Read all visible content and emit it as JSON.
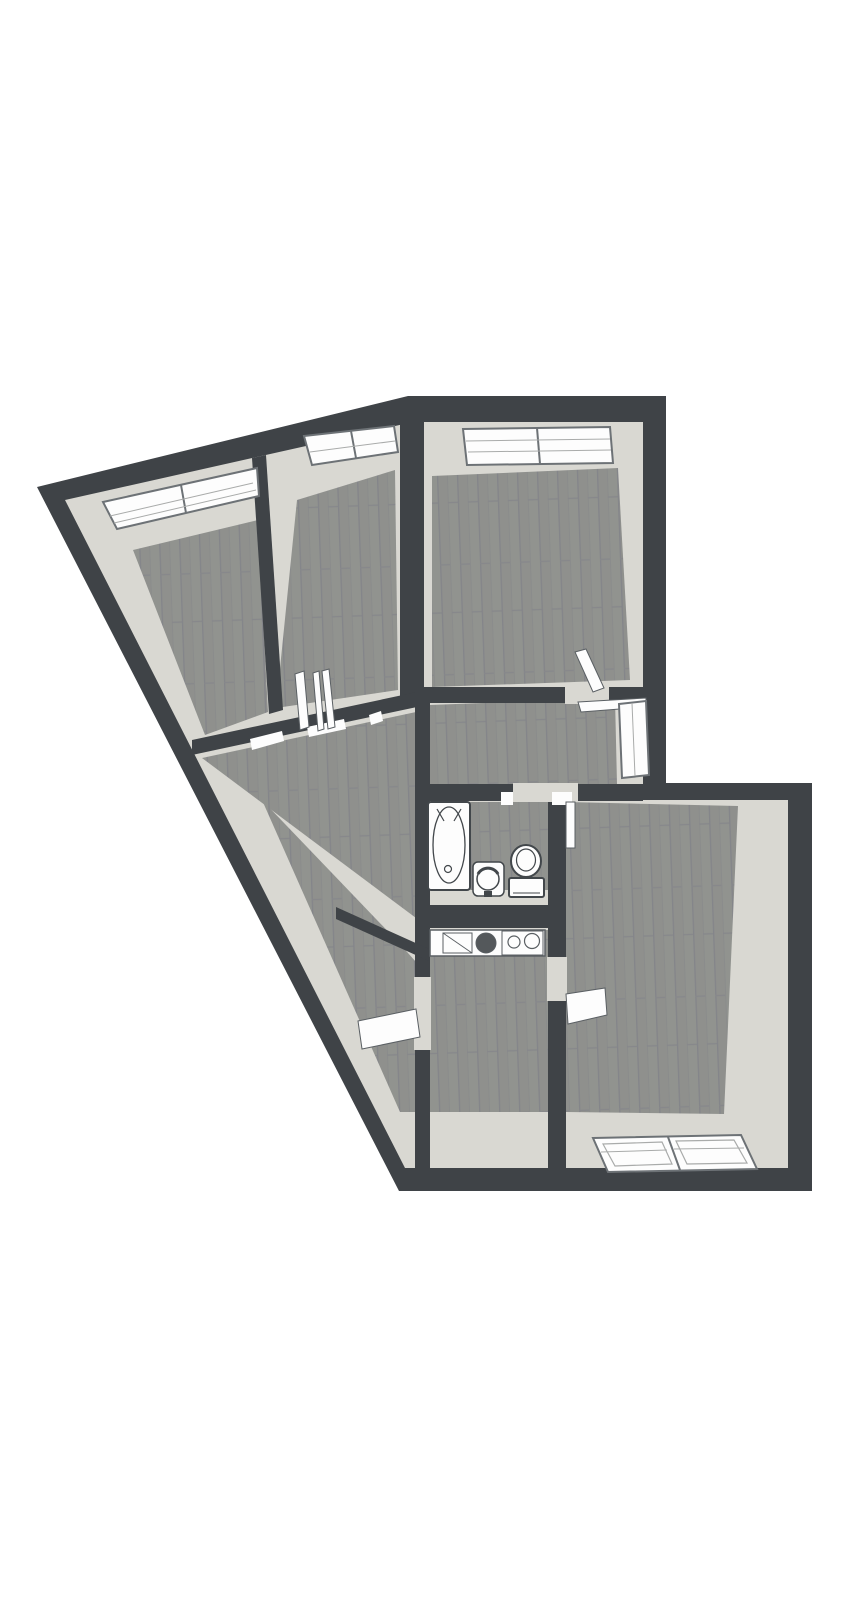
{
  "document": {
    "kind": "3d-floorplan-render",
    "description": "Top-down 3D render of an apartment floor plan, no text labels",
    "canvas": {
      "width": 867,
      "height": 1600
    }
  },
  "colors": {
    "bg": "#ffffff",
    "wall": "#3f4347",
    "face": "#d9d8d2",
    "white": "#fdfdfd",
    "outline": "#5a5f63",
    "frame": "#6d7276",
    "pane": "#a9abaa",
    "fixture": "#42474b",
    "basin": "#54585b",
    "wood_base": "#8f908d",
    "wood_half": "#94958f",
    "wood_stripe": "#84858a",
    "wood_joint": "#87888b"
  },
  "shapes": [
    {
      "name": "background",
      "type": "rect",
      "x": 0,
      "y": 0,
      "w": 867,
      "h": 1600,
      "fill": "bg"
    },
    {
      "name": "outer-wall",
      "type": "polygon",
      "points": "37,487 408,396 666,396 666,783 812,783 812,1191 399,1191",
      "fill": "wall"
    },
    {
      "name": "interior-wall-faces",
      "type": "polygon",
      "points": "65,500 413,422 643,422 643,800 788,800 788,1168 405,1168",
      "fill": "face"
    },
    {
      "name": "room1-floor",
      "type": "polygon",
      "points": "133,550 258,520 268,712 205,735",
      "fill": "wood"
    },
    {
      "name": "room2-floor",
      "type": "polygon",
      "points": "297,500 395,470 398,690 276,708",
      "fill": "wood"
    },
    {
      "name": "room3-floor",
      "type": "polygon",
      "points": "432,476 618,468 630,680 432,687",
      "fill": "wood"
    },
    {
      "name": "hallway-floor",
      "type": "polygon",
      "points": "430,705 615,698 617,784 430,787",
      "fill": "wood"
    },
    {
      "name": "living-room-floor",
      "type": "polygon",
      "points": "202,758 416,712 416,918",
      "fill": "wood"
    },
    {
      "name": "lower-left-room-floor",
      "type": "polygon",
      "points": "262,800 400,944 416,962 416,1112 400,1112",
      "fill": "wood"
    },
    {
      "name": "kitchen-floor",
      "type": "polygon",
      "points": "430,930 548,930 548,1112 430,1112",
      "fill": "wood"
    },
    {
      "name": "bedroom-floor",
      "type": "polygon",
      "points": "566,802 738,806 724,1114 566,1112",
      "fill": "wood"
    },
    {
      "name": "bathroom-floor",
      "type": "polygon",
      "points": "430,802 548,802 548,890 430,890",
      "fill": "wood"
    },
    {
      "name": "bathroom-south-face",
      "type": "rect",
      "x": 427,
      "y": 890,
      "w": 121,
      "h": 16,
      "fill": "face"
    },
    {
      "name": "wall-room1-room2",
      "type": "polygon",
      "points": "252,458 266,455 283,710 269,714",
      "fill": "wall"
    },
    {
      "name": "wall-room2-room3",
      "type": "polygon",
      "points": "400,421 424,421 424,700 400,700",
      "fill": "wall"
    },
    {
      "name": "wall-living-north",
      "type": "polygon",
      "points": "192,740 417,692 417,707 192,755",
      "fill": "wall"
    },
    {
      "name": "wall-room3-south",
      "type": "polygon",
      "points": "424,687 643,687 643,703 424,703",
      "fill": "wall"
    },
    {
      "name": "wall-hall-south",
      "type": "polygon",
      "points": "415,784 643,784 643,801 415,801",
      "fill": "wall"
    },
    {
      "name": "wall-left-spine",
      "type": "polygon",
      "points": "415,692 430,692 430,1168 415,1168",
      "fill": "wall"
    },
    {
      "name": "wall-right-spine",
      "type": "polygon",
      "points": "548,784 566,784 566,1168 548,1168",
      "fill": "wall"
    },
    {
      "name": "wall-bath-south",
      "type": "polygon",
      "points": "415,905 566,905 566,928 415,928",
      "fill": "wall"
    },
    {
      "name": "wall-living-lowerleft",
      "type": "polygon",
      "points": "336,907 429,949 429,961 336,919",
      "fill": "wall"
    },
    {
      "name": "doorway-room3",
      "type": "rect",
      "x": 565,
      "y": 686,
      "w": 44,
      "h": 18,
      "fill": "face"
    },
    {
      "name": "doorway-bedroom",
      "type": "rect",
      "x": 549,
      "y": 783,
      "w": 29,
      "h": 19,
      "fill": "face"
    },
    {
      "name": "doorway-bathroom",
      "type": "rect",
      "x": 513,
      "y": 783,
      "w": 40,
      "h": 19,
      "fill": "face"
    },
    {
      "name": "doorway-kitchen-west",
      "type": "rect",
      "x": 414,
      "y": 977,
      "w": 17,
      "h": 73,
      "fill": "face"
    },
    {
      "name": "doorway-kitchen-east",
      "type": "rect",
      "x": 547,
      "y": 957,
      "w": 20,
      "h": 44,
      "fill": "face"
    },
    {
      "name": "door-frame-living-a",
      "type": "polygon",
      "points": "250,739 282,731 284,741 252,750",
      "fill": "white"
    },
    {
      "name": "door-frame-living-b",
      "type": "polygon",
      "points": "307,727 344,719 346,729 309,737",
      "fill": "white"
    },
    {
      "name": "door-frame-living-c",
      "type": "polygon",
      "points": "369,715 381,711 383,721 371,725",
      "fill": "white"
    },
    {
      "name": "door-frame-bath-a",
      "type": "rect",
      "x": 501,
      "y": 792,
      "w": 12,
      "h": 13,
      "fill": "white"
    },
    {
      "name": "door-frame-bath-b",
      "type": "rect",
      "x": 552,
      "y": 792,
      "w": 20,
      "h": 13,
      "fill": "white"
    },
    {
      "name": "door-room1",
      "type": "polygon",
      "points": "295,674 304,671 309,727 300,730",
      "fill": "white",
      "stroke": "outline",
      "sw": 1
    },
    {
      "name": "door-room2-a",
      "type": "polygon",
      "points": "313,673 319,671 324,729 318,731",
      "fill": "white",
      "stroke": "outline",
      "sw": 1
    },
    {
      "name": "door-room2-b",
      "type": "polygon",
      "points": "322,671 329,669 335,727 328,729",
      "fill": "white",
      "stroke": "outline",
      "sw": 1
    },
    {
      "name": "door-room3",
      "type": "polygon",
      "points": "575,652 586,649 604,688 593,692",
      "fill": "white",
      "stroke": "outline",
      "sw": 1
    },
    {
      "name": "door-bedroom",
      "type": "rect",
      "x": 566,
      "y": 802,
      "w": 9,
      "h": 46,
      "fill": "white",
      "stroke": "outline",
      "sw": 1
    },
    {
      "name": "door-kitchen-west",
      "type": "polygon",
      "points": "358,1021 416,1009 420,1037 362,1049",
      "fill": "white",
      "stroke": "outline",
      "sw": 1
    },
    {
      "name": "door-kitchen-east",
      "type": "polygon",
      "points": "566,994 605,988 607,1015 568,1024",
      "fill": "white",
      "stroke": "outline",
      "sw": 1
    },
    {
      "name": "window-room1",
      "type": "polygon",
      "points": "103,502 257,468 259,496 117,529",
      "fill": "white",
      "stroke": "frame",
      "sw": 2
    },
    {
      "name": "window-room1-divider",
      "type": "line",
      "x1": 181,
      "y1": 485,
      "x2": 186,
      "y2": 513,
      "stroke": "frame",
      "sw": 2
    },
    {
      "name": "window-room1-line1",
      "type": "line",
      "x1": 110,
      "y1": 516,
      "x2": 253,
      "y2": 483,
      "stroke": "pane",
      "sw": 1
    },
    {
      "name": "window-room1-line2",
      "type": "line",
      "x1": 114,
      "y1": 523,
      "x2": 256,
      "y2": 490,
      "stroke": "pane",
      "sw": 1
    },
    {
      "name": "window-room2",
      "type": "polygon",
      "points": "304,436 394,426 398,452 312,465",
      "fill": "white",
      "stroke": "frame",
      "sw": 2
    },
    {
      "name": "window-room2-divider",
      "type": "line",
      "x1": 351,
      "y1": 431,
      "x2": 356,
      "y2": 458,
      "stroke": "frame",
      "sw": 2
    },
    {
      "name": "window-room2-line1",
      "type": "line",
      "x1": 310,
      "y1": 452,
      "x2": 395,
      "y2": 441,
      "stroke": "pane",
      "sw": 1
    },
    {
      "name": "window-room3",
      "type": "polygon",
      "points": "463,429 610,427 613,463 467,465",
      "fill": "white",
      "stroke": "frame",
      "sw": 2
    },
    {
      "name": "window-room3-divider",
      "type": "line",
      "x1": 537,
      "y1": 428,
      "x2": 540,
      "y2": 464,
      "stroke": "frame",
      "sw": 2
    },
    {
      "name": "window-room3-line1",
      "type": "line",
      "x1": 466,
      "y1": 441,
      "x2": 610,
      "y2": 439,
      "stroke": "pane",
      "sw": 1
    },
    {
      "name": "window-room3-line2",
      "type": "line",
      "x1": 468,
      "y1": 452,
      "x2": 611,
      "y2": 450,
      "stroke": "pane",
      "sw": 1
    },
    {
      "name": "window-hallway-leaf",
      "type": "polygon",
      "points": "578,702 646,698 646,707 581,712",
      "fill": "white",
      "stroke": "outline",
      "sw": 1
    },
    {
      "name": "window-hallway",
      "type": "polygon",
      "points": "619,704 646,701 649,775 622,778",
      "fill": "white",
      "stroke": "frame",
      "sw": 2
    },
    {
      "name": "window-hallway-line",
      "type": "line",
      "x1": 632,
      "y1": 703,
      "x2": 635,
      "y2": 776,
      "stroke": "pane",
      "sw": 1
    },
    {
      "name": "window-bedroom",
      "type": "polygon",
      "points": "593,1138 741,1135 757,1169 608,1172",
      "fill": "white",
      "stroke": "frame",
      "sw": 2
    },
    {
      "name": "window-bedroom-inner-left",
      "type": "polygon",
      "points": "603,1144 662,1142 672,1164 615,1166",
      "fill": "none",
      "stroke": "pane",
      "sw": 1.2
    },
    {
      "name": "window-bedroom-inner-right",
      "type": "polygon",
      "points": "676,1141 734,1140 747,1163 687,1164",
      "fill": "none",
      "stroke": "pane",
      "sw": 1.2
    },
    {
      "name": "window-bedroom-divider",
      "type": "line",
      "x1": 668,
      "y1": 1137,
      "x2": 680,
      "y2": 1170,
      "stroke": "frame",
      "sw": 2
    },
    {
      "name": "window-bedroom-line-left",
      "type": "line",
      "x1": 601,
      "y1": 1152,
      "x2": 667,
      "y2": 1150,
      "stroke": "pane",
      "sw": 1
    },
    {
      "name": "window-bedroom-line-right",
      "type": "line",
      "x1": 674,
      "y1": 1149,
      "x2": 744,
      "y2": 1148,
      "stroke": "pane",
      "sw": 1
    },
    {
      "name": "kitchen-counter",
      "type": "rect",
      "x": 430,
      "y": 930,
      "w": 115,
      "h": 26,
      "fill": "white",
      "stroke": "outline",
      "sw": 1.5
    },
    {
      "name": "kitchen-drainer",
      "type": "rect",
      "x": 443,
      "y": 933,
      "w": 29,
      "h": 20,
      "fill": "white",
      "stroke": "outline",
      "sw": 1
    },
    {
      "name": "kitchen-drainer-diag",
      "type": "line",
      "x1": 443,
      "y1": 933,
      "x2": 472,
      "y2": 953,
      "stroke": "outline",
      "sw": 0.9
    },
    {
      "name": "kitchen-sink-basin",
      "type": "circle",
      "cx": 486,
      "cy": 943,
      "r": 10,
      "fill": "basin",
      "stroke": "outline",
      "sw": 1
    },
    {
      "name": "kitchen-stove",
      "type": "rect",
      "x": 502,
      "y": 931,
      "w": 41,
      "h": 24,
      "fill": "white",
      "stroke": "outline",
      "sw": 1
    },
    {
      "name": "kitchen-burner-left",
      "type": "circle",
      "cx": 514,
      "cy": 942,
      "r": 6,
      "fill": "white",
      "stroke": "outline",
      "sw": 1.2
    },
    {
      "name": "kitchen-burner-right",
      "type": "circle",
      "cx": 532,
      "cy": 941,
      "r": 7.5,
      "fill": "white",
      "stroke": "outline",
      "sw": 1.2
    },
    {
      "name": "bathtub",
      "type": "rect",
      "x": 428,
      "y": 802,
      "w": 42,
      "h": 88,
      "rx": 3,
      "fill": "white",
      "stroke": "fixture",
      "sw": 2
    },
    {
      "name": "bathtub-basin",
      "type": "ellipse",
      "cx": 449,
      "cy": 845,
      "rx": 16,
      "ry": 38,
      "fill": "none",
      "stroke": "fixture",
      "sw": 1.3
    },
    {
      "name": "bathtub-drain",
      "type": "circle",
      "cx": 448,
      "cy": 869,
      "r": 3.5,
      "fill": "none",
      "stroke": "fixture",
      "sw": 1.2
    },
    {
      "name": "bathtub-tap-a",
      "type": "line",
      "x1": 437,
      "y1": 809,
      "x2": 444,
      "y2": 821,
      "stroke": "fixture",
      "sw": 1.2
    },
    {
      "name": "bathtub-tap-b",
      "type": "line",
      "x1": 461,
      "y1": 809,
      "x2": 454,
      "y2": 821,
      "stroke": "fixture",
      "sw": 1.2
    },
    {
      "name": "sink-pedestal",
      "type": "rect",
      "x": 473,
      "y": 862,
      "w": 31,
      "h": 34,
      "rx": 5,
      "fill": "white",
      "stroke": "fixture",
      "sw": 1.5
    },
    {
      "name": "sink-basin",
      "type": "circle",
      "cx": 488,
      "cy": 879,
      "r": 11,
      "fill": "white",
      "stroke": "fixture",
      "sw": 1.5
    },
    {
      "name": "sink-basin-arc",
      "type": "path",
      "d": "M 478,874 A 11,10 0 0 1 498,874",
      "fill": "none",
      "stroke": "fixture",
      "sw": 3
    },
    {
      "name": "sink-tap",
      "type": "rect",
      "x": 484,
      "y": 891,
      "w": 8,
      "h": 6,
      "fill": "fixture"
    },
    {
      "name": "toilet-bowl",
      "type": "ellipse",
      "cx": 526,
      "cy": 861,
      "rx": 15,
      "ry": 16,
      "fill": "white",
      "stroke": "fixture",
      "sw": 2
    },
    {
      "name": "toilet-bowl-inner",
      "type": "ellipse",
      "cx": 526,
      "cy": 860,
      "rx": 9.5,
      "ry": 11,
      "fill": "none",
      "stroke": "fixture",
      "sw": 1.2
    },
    {
      "name": "toilet-tank",
      "type": "rect",
      "x": 509,
      "y": 878,
      "w": 35,
      "h": 19,
      "rx": 2,
      "fill": "white",
      "stroke": "fixture",
      "sw": 2
    },
    {
      "name": "toilet-tank-line",
      "type": "line",
      "x1": 513,
      "y1": 893,
      "x2": 540,
      "y2": 893,
      "stroke": "fixture",
      "sw": 1
    }
  ]
}
